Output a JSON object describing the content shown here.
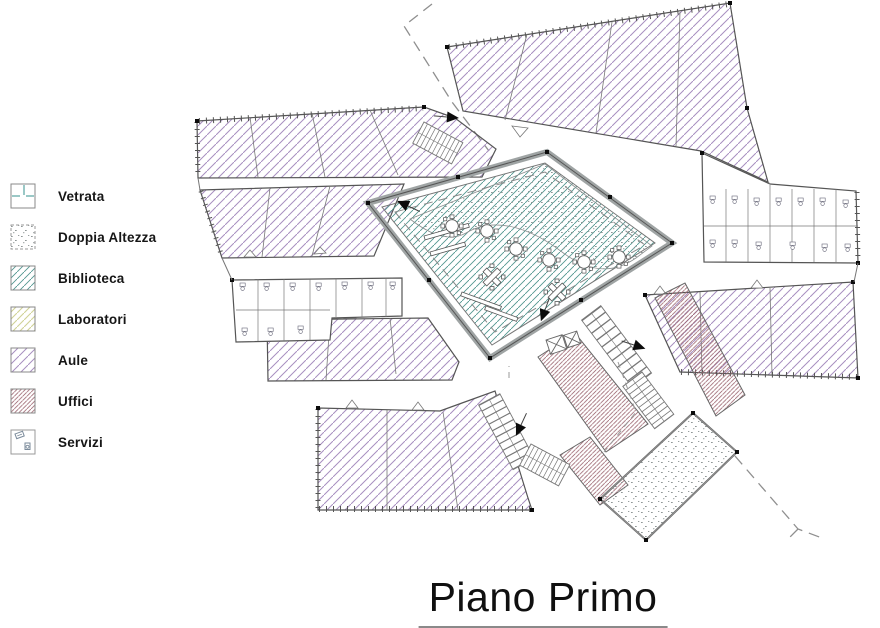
{
  "title": {
    "text": "Piano Primo"
  },
  "legend": {
    "items": [
      {
        "id": "vetrata",
        "label": "Vetrata",
        "swatch": "window-symbol",
        "color": "#6fb0ae"
      },
      {
        "id": "doppia-altezza",
        "label": "Doppia Altezza",
        "swatch": "stipple",
        "color": "#8f9696"
      },
      {
        "id": "biblioteca",
        "label": "Biblioteca",
        "swatch": "hatch",
        "color": "#52968f"
      },
      {
        "id": "laboratori",
        "label": "Laboratori",
        "swatch": "hatch",
        "color": "#cfd295"
      },
      {
        "id": "aule",
        "label": "Aule",
        "swatch": "hatch",
        "color": "#a78fc0"
      },
      {
        "id": "uffici",
        "label": "Uffici",
        "swatch": "hatch",
        "color": "#9c6670"
      },
      {
        "id": "servizi",
        "label": "Servizi",
        "swatch": "fixtures",
        "color": "#7a8a9a"
      }
    ]
  },
  "plan": {
    "floor_label": "Piano Primo",
    "wall_color": "#555555",
    "courtyard_band_color": "#9fa4a4"
  }
}
